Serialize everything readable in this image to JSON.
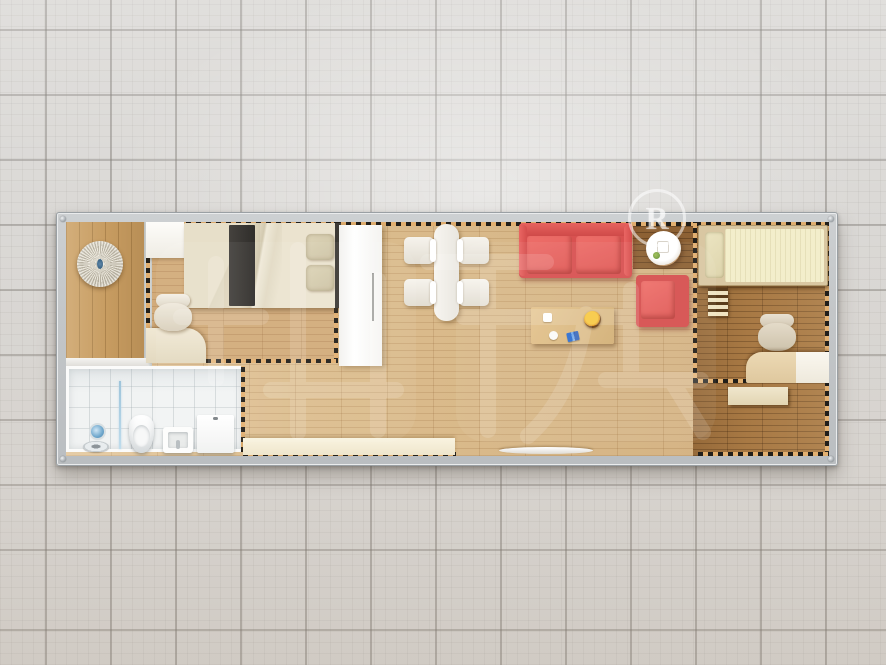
{
  "scene": {
    "type": "container-house floor plan, top-down 3D render",
    "background": "light gray ceramic tile grid",
    "modules": "long single-container layout with dashed module boundary lines"
  },
  "watermark": {
    "registered_mark": "R",
    "brand_characters": "柜族",
    "color": "#ffffff"
  },
  "palette": {
    "frame_gray": "#c6c9cb",
    "living_wood": "#dcbd8e",
    "entry_wood": "#c79c61",
    "bedroom2_wood": "#a87944",
    "sofa_red": "#d85150",
    "counter_cream": "#f6efd9",
    "bathroom_white": "#f1f3f3",
    "dash_tan": "#e2b071",
    "bed_runner_dark": "#35322e"
  },
  "rooms": [
    {
      "id": "entry",
      "label": "entry-porch"
    },
    {
      "id": "bedroom-1",
      "label": "bedroom-1"
    },
    {
      "id": "bathroom",
      "label": "bathroom"
    },
    {
      "id": "living-dining",
      "label": "living-dining"
    },
    {
      "id": "bedroom-2",
      "label": "bedroom-2"
    }
  ],
  "furniture": {
    "entry": [
      "round-ceiling-ornament"
    ],
    "bedroom1": [
      "storage-cabinet",
      "double-bed",
      "bed-runner",
      "pillows",
      "desk",
      "desk-chair"
    ],
    "bathroom": [
      "shower-head",
      "floor-drain",
      "glass-screen",
      "toilet",
      "mop-basin",
      "bath-cabinet"
    ],
    "living": [
      "wardrobe",
      "dining-table",
      "dining-chairs-x4",
      "red-sofa",
      "round-side-table",
      "red-armchair",
      "coffee-table",
      "fruit-bowl",
      "low-counter",
      "door-threshold"
    ],
    "bedroom2": [
      "single-bed",
      "bed-ladder",
      "desk-chair",
      "corner-desk",
      "side-table"
    ]
  }
}
